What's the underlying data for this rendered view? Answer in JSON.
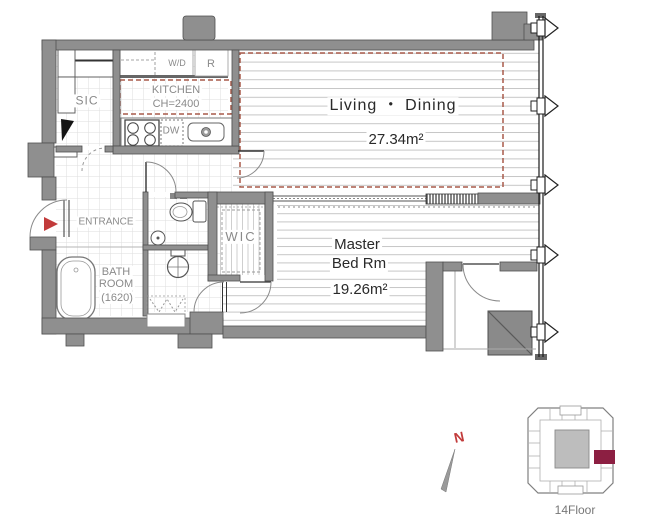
{
  "plan": {
    "rooms": {
      "living": {
        "label": "Living ・ Dining",
        "area": "27.34m²"
      },
      "bedroom": {
        "label_line1": "Master",
        "label_line2": "Bed Rm",
        "area": "19.26m²"
      },
      "kitchen": {
        "label": "KITCHEN",
        "ceiling": "CH=2400"
      },
      "bath": {
        "line1": "BATH",
        "line2": "ROOM",
        "line3": "(1620)"
      },
      "entrance": {
        "label": "ENTRANCE"
      },
      "sic": {
        "label": "SIC"
      },
      "wic": {
        "label": "WIC"
      },
      "wd": {
        "label": "W/D"
      },
      "fridge": {
        "label": "R"
      },
      "dishwasher": {
        "label": "DW"
      }
    },
    "compass": {
      "label": "N"
    },
    "keyplan": {
      "floor_label": "14Floor"
    },
    "colors": {
      "wall": "#8f8f8f",
      "wall_edge": "#4f4f4f",
      "dashed_red": "#a85a4a",
      "entrance_marker": "#c23b3b",
      "unit_highlight": "#8c1f42",
      "label_gray": "#8a8a8a",
      "text_dark": "#2a2a2a"
    }
  }
}
